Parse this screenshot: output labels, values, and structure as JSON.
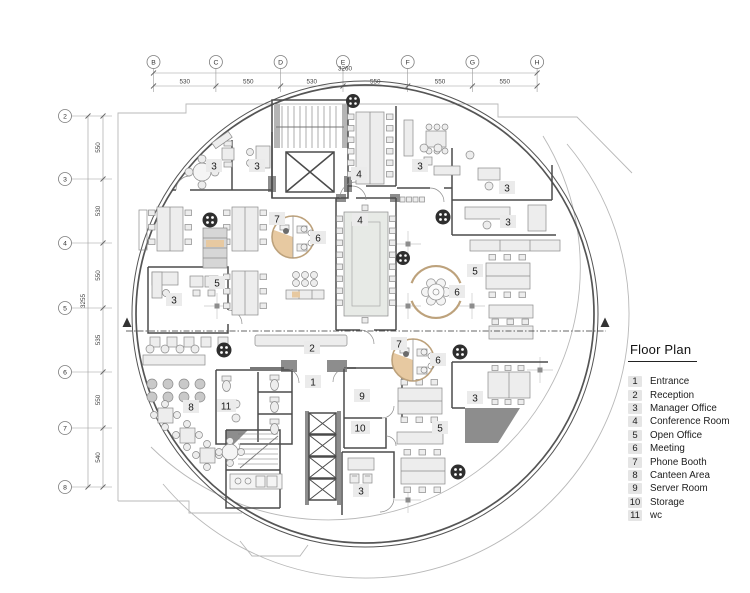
{
  "legend": {
    "title": "Floor Plan",
    "items": [
      {
        "num": "1",
        "label": "Entrance"
      },
      {
        "num": "2",
        "label": "Reception"
      },
      {
        "num": "3",
        "label": "Manager Office"
      },
      {
        "num": "4",
        "label": "Conference Room"
      },
      {
        "num": "5",
        "label": "Open Office"
      },
      {
        "num": "6",
        "label": "Meeting"
      },
      {
        "num": "7",
        "label": "Phone Booth"
      },
      {
        "num": "8",
        "label": "Canteen Area"
      },
      {
        "num": "9",
        "label": "Server Room"
      },
      {
        "num": "10",
        "label": "Storage"
      },
      {
        "num": "11",
        "label": "wc"
      }
    ]
  },
  "grid_top": {
    "total": "3260",
    "columns": [
      "B",
      "C",
      "D",
      "E",
      "F",
      "G",
      "H"
    ],
    "segments": [
      "530",
      "550",
      "530",
      "550",
      "550",
      "550"
    ]
  },
  "grid_left": {
    "total": "3255",
    "rows": [
      "2",
      "3",
      "4",
      "5",
      "6",
      "7",
      "8"
    ],
    "segments": [
      "550",
      "530",
      "550",
      "535",
      "550",
      "540"
    ]
  },
  "plan_labels": [
    "3",
    "3",
    "4",
    "3",
    "3",
    "3",
    "4",
    "7",
    "6",
    "5",
    "3",
    "5",
    "6",
    "2",
    "1",
    "9",
    "10",
    "11",
    "8",
    "7",
    "6",
    "5",
    "3",
    "3"
  ],
  "colors": {
    "booth_fill": "#e7c9a1",
    "booth_stroke": "#bda27c",
    "wall": "#4b4b4b",
    "dark_fill": "#8d8d8d",
    "furniture_fill": "#ededed",
    "label_bg": "#ebebeb",
    "dim_text": "#3f3f3f"
  }
}
